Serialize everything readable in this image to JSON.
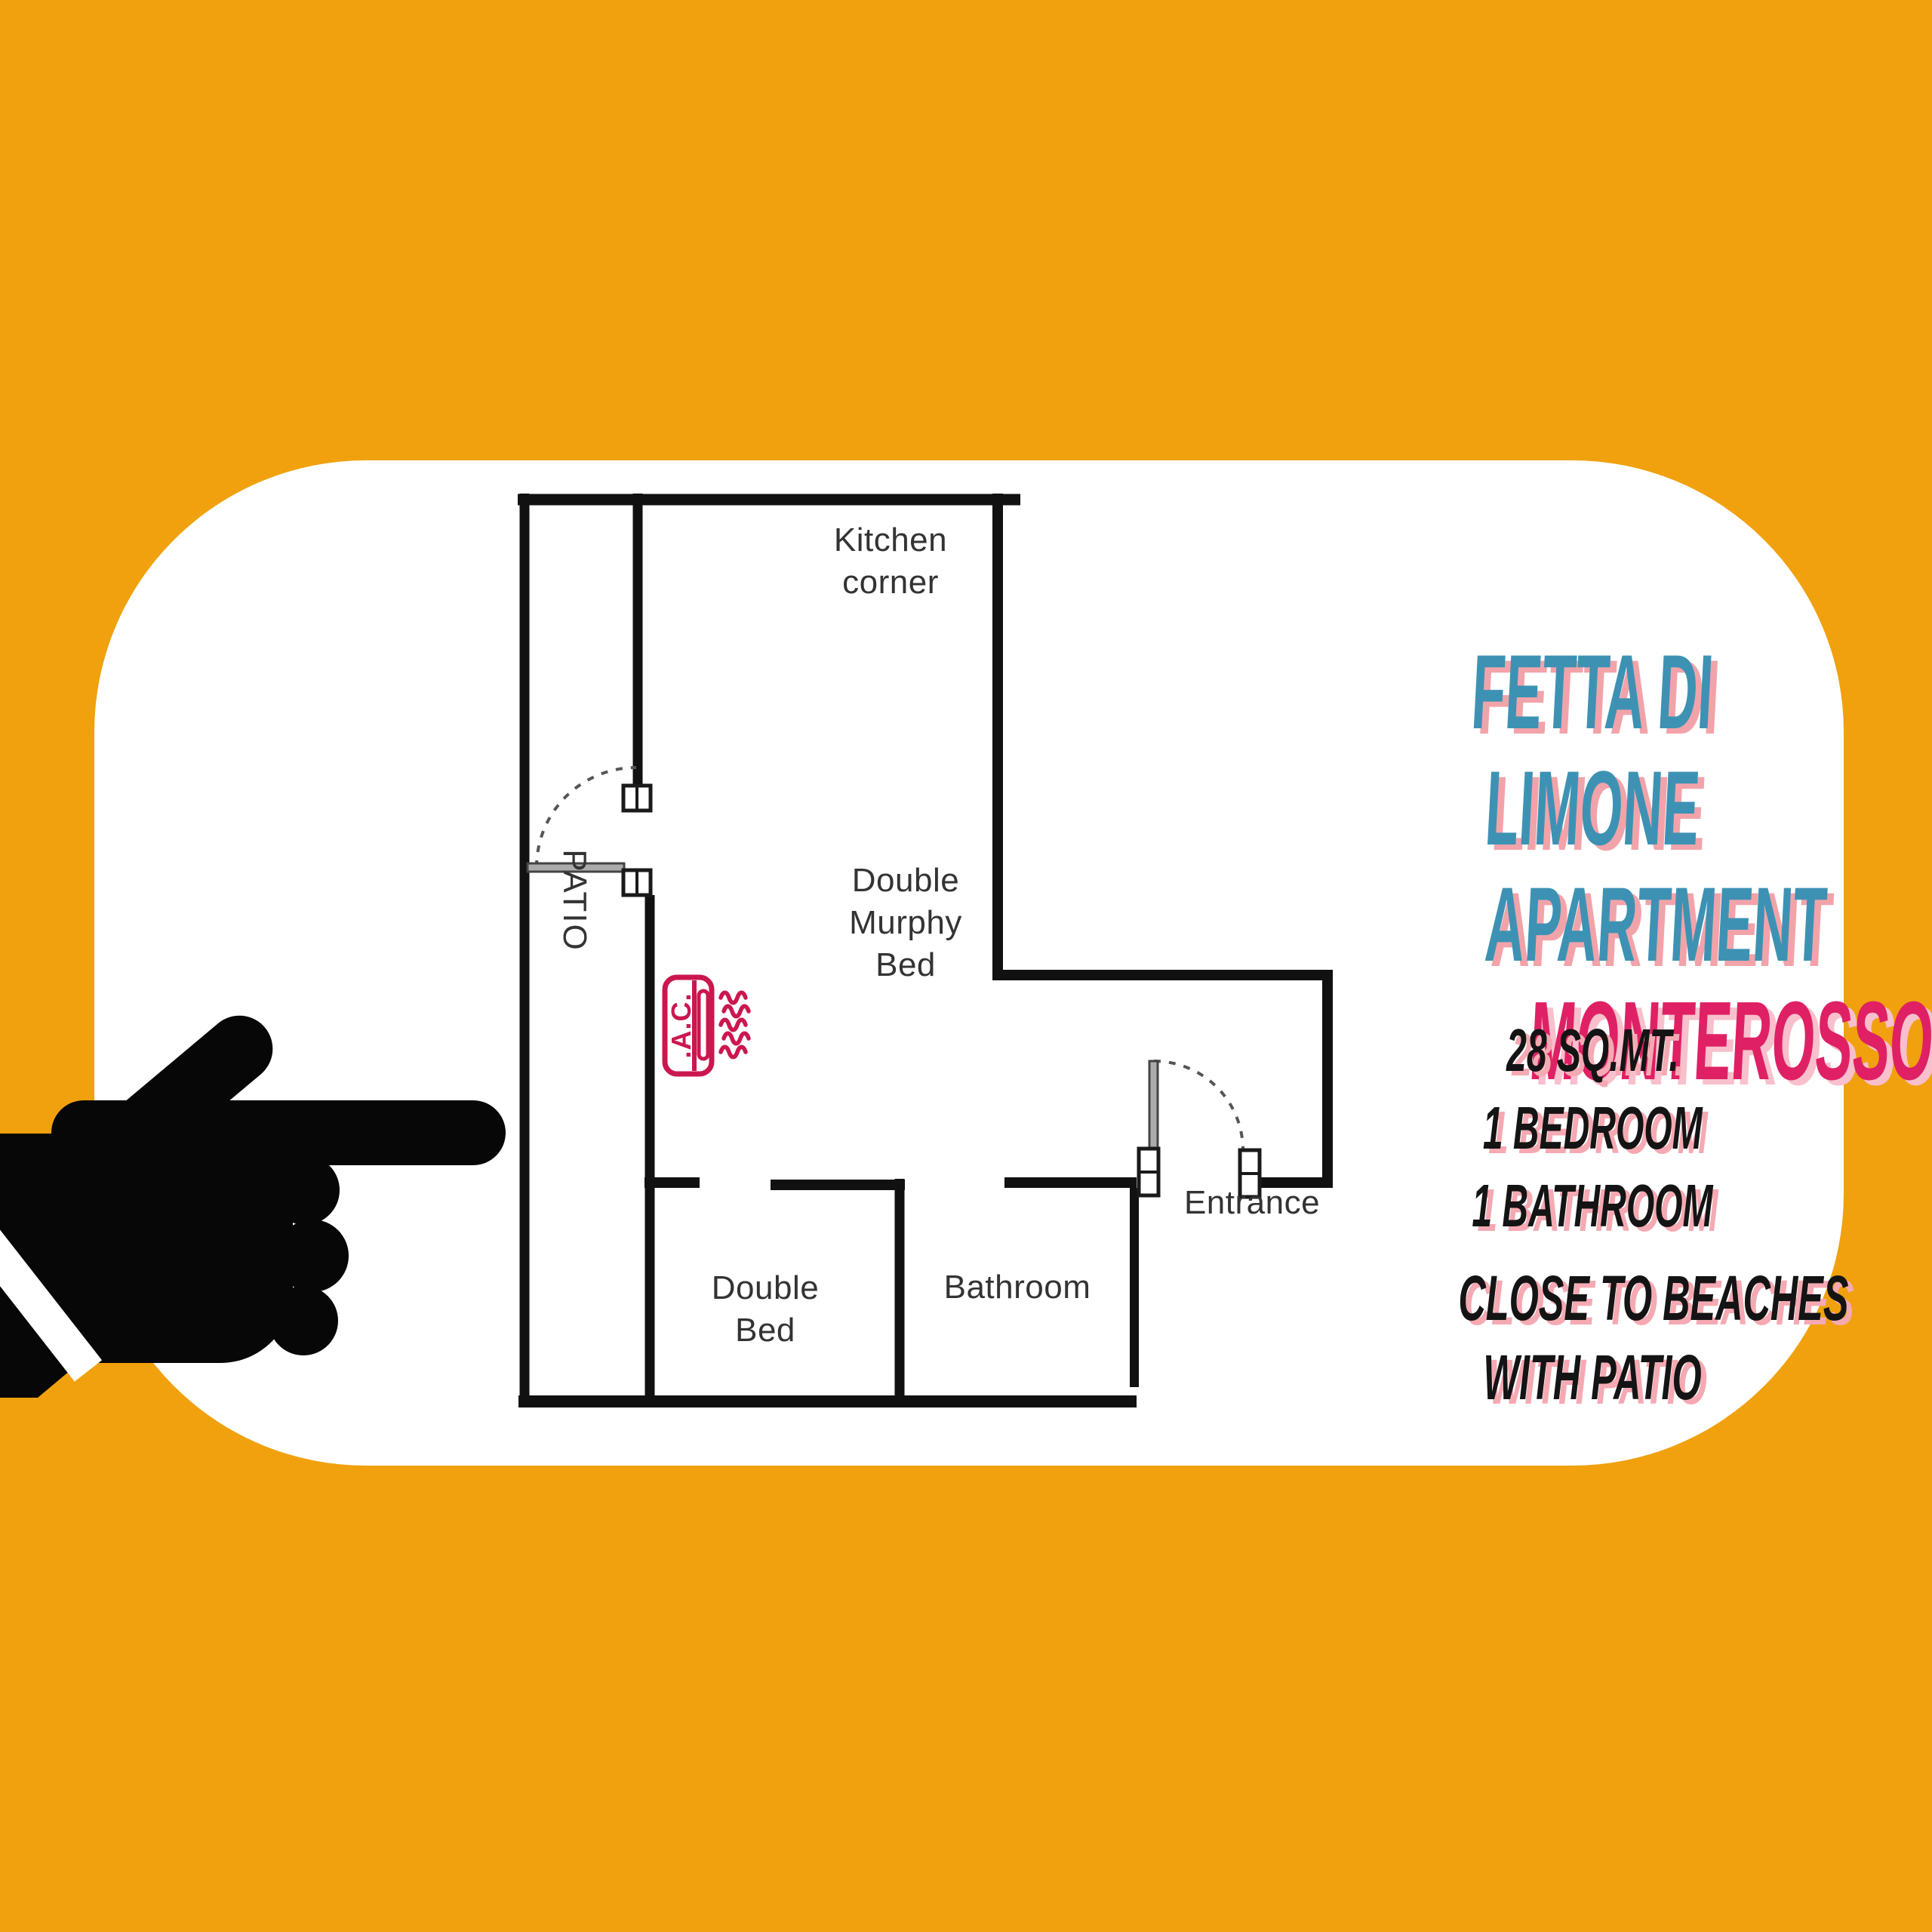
{
  "poster": {
    "background_color": "#F0A10D",
    "card_color": "#FFFFFF",
    "wall_color": "#111111",
    "accent_crimson": "#CB174F"
  },
  "floor_plan": {
    "labels": {
      "kitchen": "Kitchen\ncorner",
      "murphy_bed": "Double\nMurphy\nBed",
      "patio": "PATIO",
      "double_bed": "Double\nBed",
      "bathroom": "Bathroom",
      "entrance": "Entrance"
    },
    "ac_unit_label": ".A.C."
  },
  "info_panel": {
    "title_lines": [
      "FETTA DI",
      "LIMONE",
      "APARTMENT"
    ],
    "location": "MONTEROSSO",
    "title_color": "#3D92B4",
    "title_shadow_color": "#F2A3A9",
    "location_color": "#E02064",
    "location_shadow_color": "#F7C0CC",
    "specs": [
      "28 SQ.MT.",
      "1 BEDROOM",
      "1 BATHROOM"
    ],
    "highlights": [
      "CLOSE TO BEACHES",
      "WITH PATIO"
    ]
  }
}
